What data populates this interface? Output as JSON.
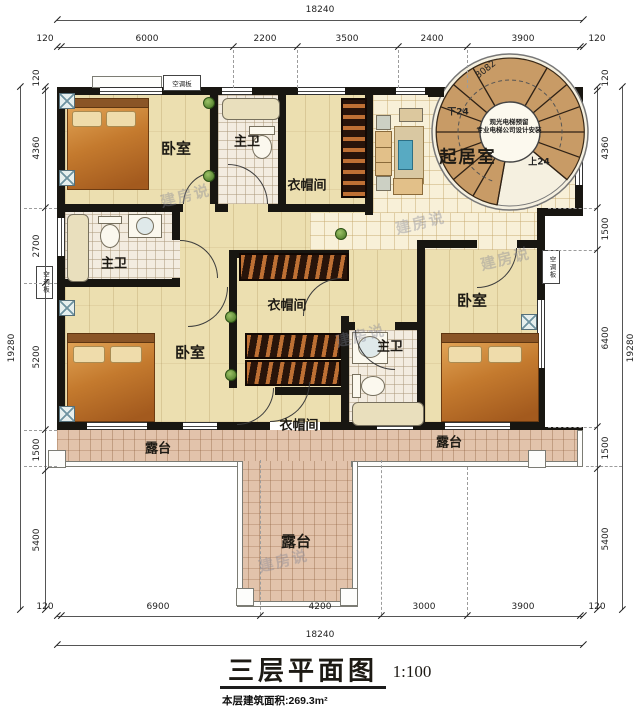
{
  "title": {
    "name": "三层平面图",
    "scale": "1:100",
    "area_note": "本层建筑面积:269.3m²"
  },
  "watermark": {
    "text": "建房说"
  },
  "rooms": [
    {
      "id": "bedroom-top-left",
      "label": "卧室"
    },
    {
      "id": "bath-top",
      "label": "主卫"
    },
    {
      "id": "closet-top",
      "label": "衣帽间"
    },
    {
      "id": "living-room",
      "label": "起居室"
    },
    {
      "id": "bath-mid-left",
      "label": "主卫"
    },
    {
      "id": "closet-center",
      "label": "衣帽间"
    },
    {
      "id": "bedroom-mid-left",
      "label": "卧室"
    },
    {
      "id": "bedroom-right",
      "label": "卧室"
    },
    {
      "id": "bath-bottom",
      "label": "主卫"
    },
    {
      "id": "closet-bottom",
      "label": "衣帽间"
    },
    {
      "id": "terrace-left",
      "label": "露台"
    },
    {
      "id": "terrace-right",
      "label": "露台"
    },
    {
      "id": "terrace-center",
      "label": "露台"
    }
  ],
  "annotations": {
    "ac_panel": "空调板",
    "stair": {
      "dim": "3082",
      "down": "下24",
      "up": "上24",
      "note_line1": "观光电梯预留",
      "note_line2": "专业电梯公司设计安装"
    }
  },
  "dimensions": {
    "top": {
      "total": "18240",
      "segments": [
        "120",
        "6000",
        "2200",
        "3500",
        "2400",
        "3900",
        "120"
      ]
    },
    "bottom": {
      "total": "18240",
      "segments": [
        "120",
        "6900",
        "4200",
        "3000",
        "3900",
        "120"
      ]
    },
    "left": {
      "total": "19280",
      "segments": [
        "120",
        "4360",
        "2700",
        "5200",
        "1500",
        "5400"
      ]
    },
    "right": {
      "total": "19280",
      "segments": [
        "120",
        "4360",
        "1500",
        "6400",
        "1500",
        "5400"
      ]
    }
  },
  "colors": {
    "wall": "#181611",
    "wood_floor": "#ecdfb0",
    "tile_cream": "#f8f0d8",
    "tile_bath": "#f3ece0",
    "tile_terrace": "#e1c5ad",
    "stair_tread": "#c89b66",
    "wardrobe": "#28140a",
    "bed": "#c47a2e"
  }
}
